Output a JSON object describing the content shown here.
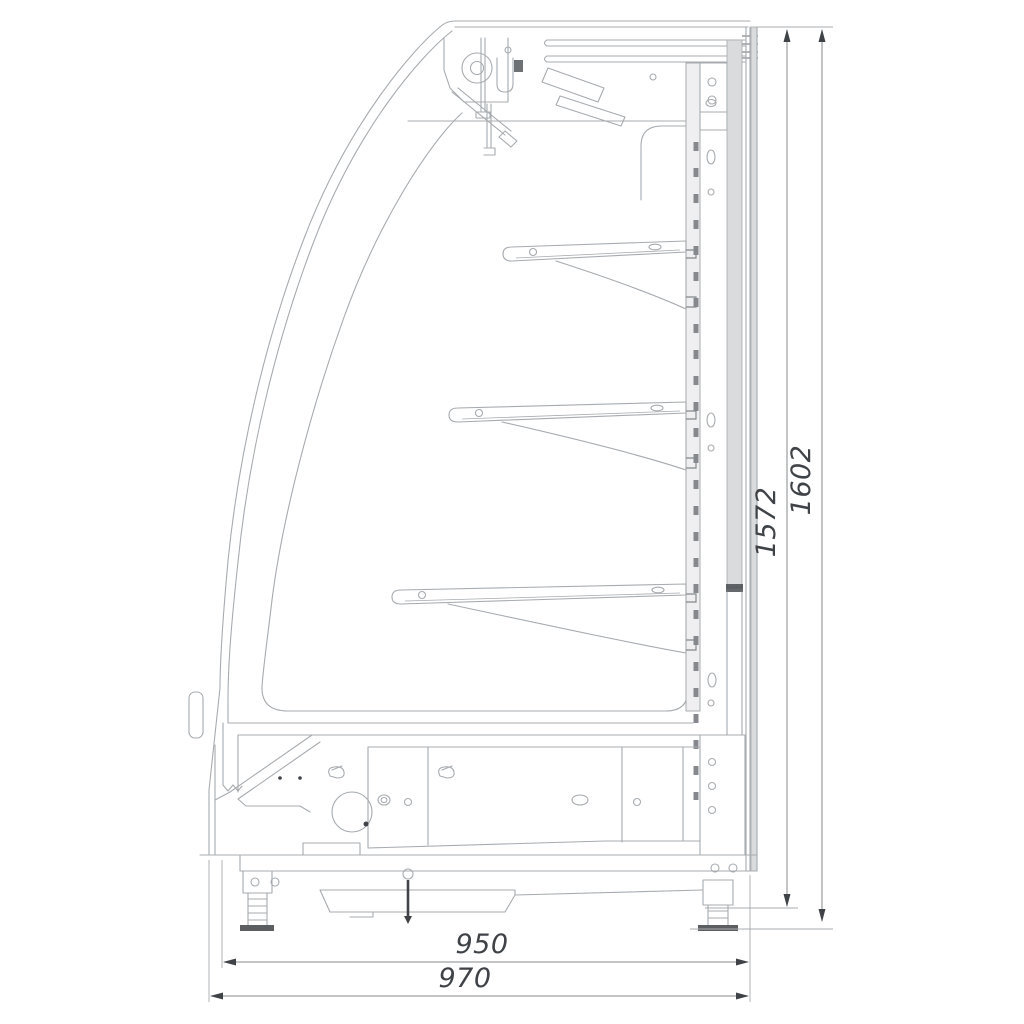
{
  "drawing": {
    "type": "technical-side-section",
    "subject": "Refrigerated display case side cross-section drawing",
    "units": "mm",
    "shelf_count": 3,
    "dimensions": {
      "overall_height": "1602",
      "body_height": "1572",
      "body_depth": "950",
      "overall_depth": "970"
    },
    "colors": {
      "background": "#ffffff",
      "line": "#a7abaf",
      "line_dark": "#85898d",
      "dim": "#3f4347",
      "fill_light": "#efeff1",
      "fill_mid": "#d9dbdd"
    }
  }
}
